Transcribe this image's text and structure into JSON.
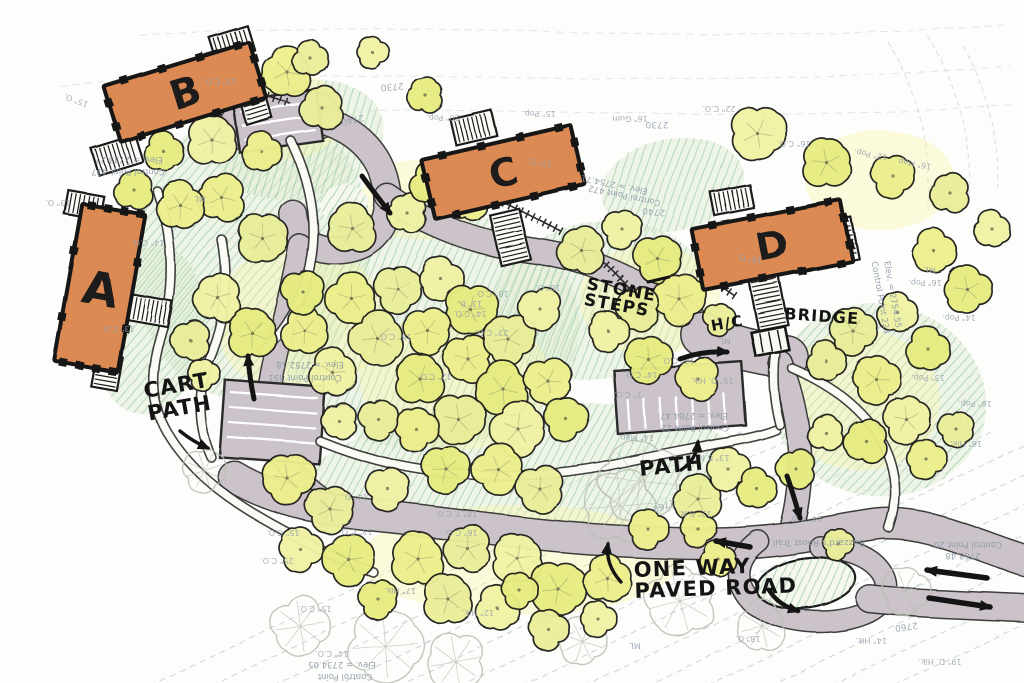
{
  "plan_title": "Hand-drawn site plan — buildings A, B, C, D",
  "palette": {
    "paper": "#FDFDFB",
    "road": "#CCC3CA",
    "road_edge": "#2E2E2E",
    "building": "#DC8A52",
    "building_outline": "#191919",
    "tree_fills": [
      "#EDEF8C",
      "#EAEE9A",
      "#F0F2A4",
      "#E7EC80"
    ],
    "tree_stroke": "#20201E",
    "tree_wash": "#F5F3A0",
    "ground_fill": "#DFEDD6",
    "green_hatch": "#7FB98A",
    "path_fill": "#FBFBF6",
    "contour": "#BFC5CC",
    "ink": "#141414",
    "survey_text": "#8C99A8",
    "tag_text": "#97A2B0",
    "ghost_tree": "#B9BEB3"
  },
  "buildings": [
    {
      "id": "A",
      "label": "A",
      "cx": 100,
      "cy": 288,
      "w": 64,
      "h": 160,
      "rot": 10,
      "ls": 46
    },
    {
      "id": "B",
      "label": "B",
      "cx": 185,
      "cy": 92,
      "w": 152,
      "h": 58,
      "rot": -17,
      "ls": 40
    },
    {
      "id": "C",
      "label": "C",
      "cx": 503,
      "cy": 172,
      "w": 154,
      "h": 60,
      "rot": -13,
      "ls": 38
    },
    {
      "id": "D",
      "label": "D",
      "cx": 772,
      "cy": 245,
      "w": 152,
      "h": 62,
      "rot": -11,
      "ls": 38
    }
  ],
  "stairs": [
    {
      "cx": 117,
      "cy": 155,
      "w": 46,
      "h": 28,
      "rot": -17
    },
    {
      "cx": 232,
      "cy": 44,
      "w": 40,
      "h": 26,
      "rot": -17
    },
    {
      "cx": 253,
      "cy": 100,
      "w": 26,
      "h": 44,
      "rot": -17
    },
    {
      "cx": 84,
      "cy": 205,
      "w": 36,
      "h": 24,
      "rot": 10
    },
    {
      "cx": 148,
      "cy": 310,
      "w": 44,
      "h": 26,
      "rot": 10
    },
    {
      "cx": 107,
      "cy": 372,
      "w": 26,
      "h": 34,
      "rot": 10
    },
    {
      "cx": 474,
      "cy": 128,
      "w": 42,
      "h": 26,
      "rot": -13
    },
    {
      "cx": 510,
      "cy": 237,
      "w": 30,
      "h": 52,
      "rot": -13
    },
    {
      "cx": 732,
      "cy": 200,
      "w": 40,
      "h": 24,
      "rot": -11
    },
    {
      "cx": 843,
      "cy": 240,
      "w": 24,
      "h": 42,
      "rot": -11
    },
    {
      "cx": 768,
      "cy": 300,
      "w": 30,
      "h": 56,
      "rot": -11
    }
  ],
  "bridge": {
    "cx": 770,
    "cy": 341,
    "w": 34,
    "h": 24,
    "rot": -11
  },
  "roads": [
    {
      "id": "court-b",
      "d": "M 243,126 L 316,116",
      "w": 46
    },
    {
      "id": "loop-upper",
      "d": "M 310,118 C 352,124 382,152 387,192 C 391,226 372,247 342,250 C 312,253 295,238 293,214",
      "w": 26
    },
    {
      "id": "road-to-lot",
      "d": "M 300,246 C 291,298 279,338 272,374 C 267,401 267,424 277,447",
      "w": 22
    },
    {
      "id": "road-upper-right",
      "d": "M 387,196 C 428,226 478,243 528,250 C 574,256 608,268 648,290 C 678,306 700,322 715,340",
      "w": 24
    },
    {
      "id": "court-hc",
      "d": "M 702,334 C 732,348 760,353 786,357",
      "w": 42
    },
    {
      "id": "road-d-down",
      "d": "M 780,362 C 793,396 800,430 800,464 C 800,494 795,519 788,541",
      "w": 22
    },
    {
      "id": "road-lot-to-bottom",
      "d": "M 277,447 C 293,477 315,497 344,511",
      "w": 20
    },
    {
      "id": "road-bottom",
      "d": "M 234,477 C 279,504 330,511 390,517 C 470,526 540,537 620,541 C 680,544 720,545 755,542 C 800,539 840,529 878,524 C 920,520 962,539 1005,554 L 1026,561",
      "w": 30
    },
    {
      "id": "road-island-loop",
      "d": "M 758,541 C 734,559 732,584 754,604 C 779,622 830,628 864,614 C 889,604 892,584 879,569 C 869,557 849,549 820,547",
      "w": 20
    },
    {
      "id": "road-exit",
      "d": "M 870,599 C 918,604 968,605 1026,608",
      "w": 26
    }
  ],
  "parking_lots": [
    {
      "id": "lot-left",
      "cx": 272,
      "cy": 422,
      "w": 100,
      "h": 78,
      "rot": 4,
      "stalls": "h",
      "gap": 15
    },
    {
      "id": "lot-right",
      "cx": 680,
      "cy": 398,
      "w": 128,
      "h": 64,
      "rot": -4,
      "stalls": "v",
      "gap": 16
    },
    {
      "id": "court-b-stalls",
      "cx": 278,
      "cy": 121,
      "w": 84,
      "h": 52,
      "rot": -8,
      "stalls": "h",
      "gap": 14
    }
  ],
  "islands": [
    {
      "cx": 806,
      "cy": 583,
      "rx": 50,
      "ry": 25,
      "rot": -8,
      "outline": true
    },
    {
      "cx": 344,
      "cy": 204,
      "rx": 24,
      "ry": 20,
      "rot": 0,
      "outline": false
    }
  ],
  "foot_paths": [
    {
      "id": "cart-path-west",
      "d": "M 158,192 C 174,240 175,290 160,338 C 150,372 150,402 167,432 C 184,462 215,490 251,512 C 291,536 331,556 373,572"
    },
    {
      "id": "path-b-south",
      "d": "M 291,141 C 310,180 319,224 310,266 C 303,300 286,329 263,351"
    },
    {
      "id": "path-central",
      "d": "M 320,441 C 371,462 421,472 476,475 C 531,478 581,472 626,462 C 657,455 686,450 716,444 C 741,440 761,436 776,430"
    },
    {
      "id": "path-east",
      "d": "M 792,368 C 831,385 863,408 881,440 C 897,468 899,500 889,528"
    },
    {
      "id": "path-a-east",
      "d": "M 222,240 C 230,282 224,322 208,360 C 196,394 198,428 211,457"
    },
    {
      "id": "path-bridge",
      "d": "M 775,352 C 772,376 774,402 780,425"
    }
  ],
  "step_paths": [
    {
      "id": "steps-below-c",
      "d": "M 420,166 C 470,186 520,209 562,232"
    },
    {
      "id": "stone-steps",
      "d": "M 597,257 C 621,276 639,298 650,321"
    },
    {
      "id": "steps-b-court",
      "d": "M 243,88 L 290,103"
    },
    {
      "id": "steps-hc",
      "d": "M 713,281 L 735,296"
    }
  ],
  "green_areas": [
    {
      "cx": 252,
      "cy": 252,
      "rx": 118,
      "ry": 148,
      "rot": 8
    },
    {
      "cx": 300,
      "cy": 140,
      "rx": 85,
      "ry": 58,
      "rot": -15
    },
    {
      "cx": 430,
      "cy": 330,
      "rx": 150,
      "ry": 118,
      "rot": -8
    },
    {
      "cx": 600,
      "cy": 300,
      "rx": 108,
      "ry": 78,
      "rot": -10
    },
    {
      "cx": 520,
      "cy": 472,
      "rx": 215,
      "ry": 68,
      "rot": -4
    },
    {
      "cx": 672,
      "cy": 185,
      "rx": 72,
      "ry": 46,
      "rot": -12
    },
    {
      "cx": 878,
      "cy": 400,
      "rx": 108,
      "ry": 96,
      "rot": 10
    },
    {
      "cx": 150,
      "cy": 330,
      "rx": 55,
      "ry": 85,
      "rot": 8
    },
    {
      "cx": 806,
      "cy": 583,
      "rx": 50,
      "ry": 25,
      "rot": -8
    }
  ],
  "yellow_washes": [
    {
      "cx": 300,
      "cy": 320,
      "rx": 85,
      "ry": 75
    },
    {
      "cx": 455,
      "cy": 380,
      "rx": 95,
      "ry": 70
    },
    {
      "cx": 520,
      "cy": 560,
      "rx": 160,
      "ry": 55
    },
    {
      "cx": 860,
      "cy": 400,
      "rx": 80,
      "ry": 70
    },
    {
      "cx": 280,
      "cy": 115,
      "rx": 65,
      "ry": 45
    },
    {
      "cx": 650,
      "cy": 300,
      "rx": 70,
      "ry": 55
    },
    {
      "cx": 880,
      "cy": 180,
      "rx": 75,
      "ry": 50
    },
    {
      "cx": 420,
      "cy": 200,
      "rx": 60,
      "ry": 40
    }
  ],
  "trees": [
    [
      287,
      72,
      26
    ],
    [
      322,
      108,
      22
    ],
    [
      212,
      140,
      26
    ],
    [
      164,
      152,
      20
    ],
    [
      262,
      152,
      20
    ],
    [
      310,
      58,
      18
    ],
    [
      372,
      52,
      16
    ],
    [
      426,
      96,
      18
    ],
    [
      222,
      198,
      24
    ],
    [
      262,
      238,
      26
    ],
    [
      218,
      298,
      24
    ],
    [
      252,
      333,
      26
    ],
    [
      305,
      331,
      24
    ],
    [
      190,
      340,
      20
    ],
    [
      203,
      374,
      16
    ],
    [
      134,
      190,
      20
    ],
    [
      181,
      206,
      24
    ],
    [
      352,
      228,
      26
    ],
    [
      407,
      213,
      20
    ],
    [
      303,
      292,
      22
    ],
    [
      352,
      299,
      26
    ],
    [
      398,
      289,
      24
    ],
    [
      441,
      279,
      22
    ],
    [
      470,
      309,
      26
    ],
    [
      428,
      331,
      24
    ],
    [
      378,
      339,
      28
    ],
    [
      333,
      373,
      24
    ],
    [
      420,
      379,
      26
    ],
    [
      468,
      359,
      24
    ],
    [
      508,
      339,
      26
    ],
    [
      540,
      309,
      22
    ],
    [
      503,
      389,
      28
    ],
    [
      548,
      381,
      24
    ],
    [
      458,
      419,
      26
    ],
    [
      518,
      429,
      28
    ],
    [
      566,
      419,
      22
    ],
    [
      416,
      429,
      22
    ],
    [
      378,
      419,
      20
    ],
    [
      339,
      421,
      18
    ],
    [
      432,
      183,
      22
    ],
    [
      468,
      201,
      20
    ],
    [
      582,
      251,
      24
    ],
    [
      622,
      229,
      20
    ],
    [
      658,
      259,
      24
    ],
    [
      679,
      299,
      26
    ],
    [
      638,
      309,
      22
    ],
    [
      608,
      331,
      20
    ],
    [
      648,
      359,
      24
    ],
    [
      698,
      379,
      22
    ],
    [
      719,
      319,
      16
    ],
    [
      757,
      133,
      28
    ],
    [
      827,
      163,
      26
    ],
    [
      893,
      176,
      22
    ],
    [
      951,
      194,
      20
    ],
    [
      992,
      229,
      18
    ],
    [
      967,
      289,
      24
    ],
    [
      934,
      251,
      22
    ],
    [
      853,
      331,
      24
    ],
    [
      898,
      313,
      20
    ],
    [
      928,
      349,
      22
    ],
    [
      876,
      379,
      24
    ],
    [
      826,
      361,
      20
    ],
    [
      906,
      419,
      24
    ],
    [
      866,
      441,
      22
    ],
    [
      926,
      459,
      20
    ],
    [
      956,
      429,
      18
    ],
    [
      826,
      433,
      18
    ],
    [
      796,
      469,
      20
    ],
    [
      288,
      479,
      26
    ],
    [
      330,
      509,
      24
    ],
    [
      388,
      489,
      22
    ],
    [
      446,
      469,
      24
    ],
    [
      498,
      469,
      26
    ],
    [
      540,
      489,
      24
    ],
    [
      300,
      549,
      22
    ],
    [
      348,
      559,
      26
    ],
    [
      418,
      559,
      28
    ],
    [
      468,
      549,
      24
    ],
    [
      518,
      559,
      26
    ],
    [
      558,
      589,
      28
    ],
    [
      608,
      579,
      24
    ],
    [
      448,
      599,
      26
    ],
    [
      498,
      609,
      22
    ],
    [
      378,
      599,
      20
    ],
    [
      648,
      529,
      20
    ],
    [
      698,
      499,
      24
    ],
    [
      728,
      469,
      22
    ],
    [
      757,
      489,
      20
    ],
    [
      698,
      529,
      18
    ],
    [
      548,
      629,
      20
    ],
    [
      598,
      619,
      18
    ],
    [
      520,
      591,
      18
    ],
    [
      718,
      559,
      18
    ],
    [
      838,
      544,
      16
    ]
  ],
  "ghost_trees": [
    [
      385,
      646,
      38
    ],
    [
      300,
      626,
      30
    ],
    [
      455,
      661,
      30
    ],
    [
      680,
      601,
      36
    ],
    [
      762,
      626,
      26
    ],
    [
      906,
      591,
      24
    ],
    [
      640,
      481,
      42
    ],
    [
      582,
      641,
      24
    ],
    [
      620,
      506,
      38
    ],
    [
      204,
      470,
      22
    ]
  ],
  "contours": {
    "bottom": {
      "count": 13,
      "x0": 120,
      "y0": 700,
      "step": 62,
      "dx": 560,
      "dy": -268
    },
    "top": [
      "M 140,36 C 400,14 700,50 1010,24",
      "M 60,86 C 330,60 640,96 1010,66",
      "M 120,118 C 400,96 700,130 1015,104"
    ],
    "ravine": [
      "M 888,42 C 918,92 933,152 928,212",
      "M 928,36 C 958,86 973,142 970,202",
      "M 963,46 C 988,92 1000,142 998,192"
    ]
  },
  "annotations": [
    {
      "id": "cart-path",
      "lines": [
        "CART",
        "PATH"
      ],
      "x": 145,
      "y": 398,
      "rot": -10,
      "size": 21,
      "lh": 23
    },
    {
      "id": "path-label",
      "lines": [
        "PATH"
      ],
      "x": 640,
      "y": 476,
      "rot": -6,
      "size": 21,
      "lh": 22
    },
    {
      "id": "one-way",
      "lines": [
        "ONE WAY",
        "PAVED ROAD"
      ],
      "x": 634,
      "y": 577,
      "rot": -2,
      "size": 21,
      "lh": 21
    },
    {
      "id": "stone-steps",
      "lines": [
        "STONE",
        "STEPS"
      ],
      "x": 586,
      "y": 289,
      "rot": 10,
      "size": 17,
      "lh": 16
    },
    {
      "id": "hc",
      "lines": [
        "H/C"
      ],
      "x": 712,
      "y": 331,
      "rot": -10,
      "size": 15,
      "lh": 16
    },
    {
      "id": "bridge",
      "lines": [
        "BRIDGE"
      ],
      "x": 784,
      "y": 319,
      "rot": 4,
      "size": 16,
      "lh": 17
    }
  ],
  "arrows": [
    {
      "id": "dir-upper-road",
      "d": "M 362,176 C 372,190 381,201 390,213",
      "w": 5
    },
    {
      "id": "dir-left-lot",
      "d": "M 254,399 C 251,385 249,371 248,356",
      "w": 5
    },
    {
      "id": "dir-hc-lot",
      "d": "M 680,359 C 696,353 711,351 727,352",
      "w": 5
    },
    {
      "id": "dir-d-road",
      "d": "M 787,476 C 792,490 796,504 800,518",
      "w": 5
    },
    {
      "id": "dir-bottom-west",
      "d": "M 750,547 L 716,541",
      "w": 5.5
    },
    {
      "id": "two-way-in",
      "d": "M 987,578 L 927,570",
      "w": 5.5
    },
    {
      "id": "two-way-out",
      "d": "M 929,598 L 990,607",
      "w": 5.5
    },
    {
      "id": "dir-island-loop",
      "d": "M 769,590 C 775,600 785,607 798,611",
      "w": 4.5
    },
    {
      "id": "leader-path",
      "d": "M 681,470 C 692,463 697,453 698,442",
      "w": 3.4
    },
    {
      "id": "leader-one-way",
      "d": "M 621,582 C 611,571 606,558 608,544",
      "w": 3.4
    },
    {
      "id": "leader-cart-path",
      "d": "M 180,431 C 191,440 199,444 208,448",
      "w": 3.4
    },
    {
      "id": "leader-stone-steps",
      "d": "M 648,282 L 669,277",
      "w": 3,
      "head": false
    }
  ],
  "survey_labels": [
    {
      "t": "Elev. = 2733.27",
      "x": 129,
      "y": 157,
      "r": 180
    },
    {
      "t": "Control Point 437",
      "x": 128,
      "y": 169,
      "r": 180
    },
    {
      "t": "Elev. = 2754.71",
      "x": 615,
      "y": 182,
      "r": 192
    },
    {
      "t": "Control Point 472",
      "x": 625,
      "y": 193,
      "r": 192
    },
    {
      "t": "Elev. = 2752.18",
      "x": 310,
      "y": 362,
      "r": 180
    },
    {
      "t": "Control Point 391",
      "x": 305,
      "y": 375,
      "r": 180
    },
    {
      "t": "Elev. = 2764.47",
      "x": 694,
      "y": 413,
      "r": 180
    },
    {
      "t": "Control Point 22",
      "x": 695,
      "y": 425,
      "r": 180
    },
    {
      "t": "2768.48",
      "x": 963,
      "y": 553,
      "r": 180
    },
    {
      "t": "Control Point 20",
      "x": 968,
      "y": 542,
      "r": 180
    },
    {
      "t": "Elev. = 2734.05",
      "x": 342,
      "y": 662,
      "r": 180
    },
    {
      "t": "Control Point",
      "x": 345,
      "y": 674,
      "r": 180
    },
    {
      "t": "Control Point 223",
      "x": 878,
      "y": 298,
      "r": 80
    },
    {
      "t": "Elev. = 2754.55",
      "x": 890,
      "y": 295,
      "r": 80
    },
    {
      "t": "Buzzard's Roost Trail",
      "x": 819,
      "y": 540,
      "r": 180,
      "s": 9
    }
  ],
  "contour_labels": [
    {
      "t": "2730",
      "x": 392,
      "y": 84,
      "r": 175
    },
    {
      "t": "2740",
      "x": 352,
      "y": 117,
      "r": 168
    },
    {
      "t": "2730",
      "x": 657,
      "y": 122,
      "r": 180
    },
    {
      "t": "2740",
      "x": 654,
      "y": 209,
      "r": 185
    },
    {
      "t": "2760",
      "x": 663,
      "y": 503,
      "r": 160
    },
    {
      "t": "2760",
      "x": 906,
      "y": 624,
      "r": 172
    }
  ],
  "tree_tags": [
    {
      "t": "20\" Pop.",
      "x": 443,
      "y": 115
    },
    {
      "t": "15\" Pop.",
      "x": 539,
      "y": 111
    },
    {
      "t": "16\" Gum",
      "x": 630,
      "y": 116
    },
    {
      "t": "22\" C.O.",
      "x": 719,
      "y": 106
    },
    {
      "t": "16\" C.O.",
      "x": 794,
      "y": 141
    },
    {
      "t": "12\" Pop.",
      "x": 871,
      "y": 152,
      "r": 190
    },
    {
      "t": "16\" Map.",
      "x": 914,
      "y": 161,
      "r": 190
    },
    {
      "t": "16\" Pop.",
      "x": 925,
      "y": 280
    },
    {
      "t": "14\" Pop.",
      "x": 959,
      "y": 315
    },
    {
      "t": "13\" Pop.",
      "x": 928,
      "y": 375
    },
    {
      "t": "16\" Pop.",
      "x": 975,
      "y": 401
    },
    {
      "t": "16\" Hik.",
      "x": 966,
      "y": 441
    },
    {
      "t": "ML",
      "x": 930,
      "y": 267
    },
    {
      "t": "14\" Hik.",
      "x": 871,
      "y": 638
    },
    {
      "t": "19\" D. Hik.",
      "x": 940,
      "y": 659
    },
    {
      "t": "18\" O.",
      "x": 748,
      "y": 636
    },
    {
      "t": "17\" Hik.",
      "x": 400,
      "y": 588
    },
    {
      "t": "12\" Hik.",
      "x": 478,
      "y": 610
    },
    {
      "t": "25\" C.O.",
      "x": 277,
      "y": 558
    },
    {
      "t": "15\" C.O.",
      "x": 315,
      "y": 606
    },
    {
      "t": "14\" C.O.",
      "x": 332,
      "y": 651
    },
    {
      "t": "14\" D.",
      "x": 355,
      "y": 494
    },
    {
      "t": "18\" T. C.O.",
      "x": 456,
      "y": 511
    },
    {
      "t": "15\" C.O.",
      "x": 283,
      "y": 530
    },
    {
      "t": "13\" C.O.",
      "x": 356,
      "y": 529
    },
    {
      "t": "16\" C.O.",
      "x": 461,
      "y": 530
    },
    {
      "t": "15\" D. Hik.",
      "x": 712,
      "y": 378
    },
    {
      "t": "7\" C.O.",
      "x": 628,
      "y": 392
    },
    {
      "t": "14\" C.O.",
      "x": 641,
      "y": 372
    },
    {
      "t": "16\" C.O.",
      "x": 678,
      "y": 358
    },
    {
      "t": "13\" B.N.",
      "x": 713,
      "y": 455
    },
    {
      "t": "12\" B.N.",
      "x": 695,
      "y": 511
    },
    {
      "t": "14\" Map.",
      "x": 636,
      "y": 435
    },
    {
      "t": "14\" Pop.",
      "x": 806,
      "y": 516
    },
    {
      "t": "13\" C.O.",
      "x": 220,
      "y": 79
    },
    {
      "t": "15\" O.",
      "x": 77,
      "y": 98,
      "r": 200
    },
    {
      "t": "13\" O.",
      "x": 58,
      "y": 200
    },
    {
      "t": "18\" O.",
      "x": 548,
      "y": 285
    },
    {
      "t": "23\" C.O.",
      "x": 492,
      "y": 330
    },
    {
      "t": "14\" C.O.",
      "x": 470,
      "y": 311
    },
    {
      "t": "12\" C.O.",
      "x": 435,
      "y": 374
    },
    {
      "t": "18\" C.O.",
      "x": 492,
      "y": 291
    },
    {
      "t": "15\" C.O.",
      "x": 395,
      "y": 334
    },
    {
      "t": "13\" B.",
      "x": 470,
      "y": 301
    },
    {
      "t": "ML",
      "x": 200,
      "y": 196
    },
    {
      "t": "ML",
      "x": 725,
      "y": 338
    },
    {
      "t": "ML",
      "x": 635,
      "y": 643
    },
    {
      "t": "15\" D.",
      "x": 540,
      "y": 160,
      "r": 190
    },
    {
      "t": "18\" D.",
      "x": 750,
      "y": 256,
      "r": 190
    },
    {
      "t": "14\" C.O.",
      "x": 148,
      "y": 240
    },
    {
      "t": "13\" C.O.",
      "x": 118,
      "y": 326
    }
  ]
}
